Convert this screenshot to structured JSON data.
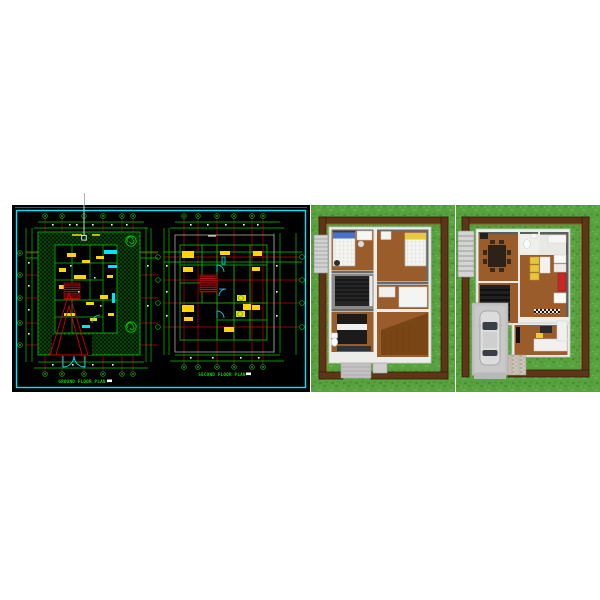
{
  "cad": {
    "plan_left_title": "GROUND FLOOR PLAN",
    "plan_right_title": "SECOND FLOOR PLAN",
    "colors": {
      "background": "#000000",
      "viewport_border": "#00e5ff",
      "walls": "#00d000",
      "column_grid": "#d00000",
      "furniture": "#ffd400",
      "fixtures_doors": "#00e5ff",
      "dimension_marks": "#ffffff"
    }
  },
  "renders": {
    "colors": {
      "grass": "#58a13f",
      "fence": "#5f3517",
      "wood_floor": "#9a5c2a",
      "walls": "#ecece9",
      "stairs": "#262626",
      "kitchen_counter": "#e7c53d",
      "refrigerator": "#c62828",
      "car_body": "#dcdcdc",
      "pillow_blue": "#4a72c8",
      "pillow_yellow": "#e8c83c"
    }
  }
}
